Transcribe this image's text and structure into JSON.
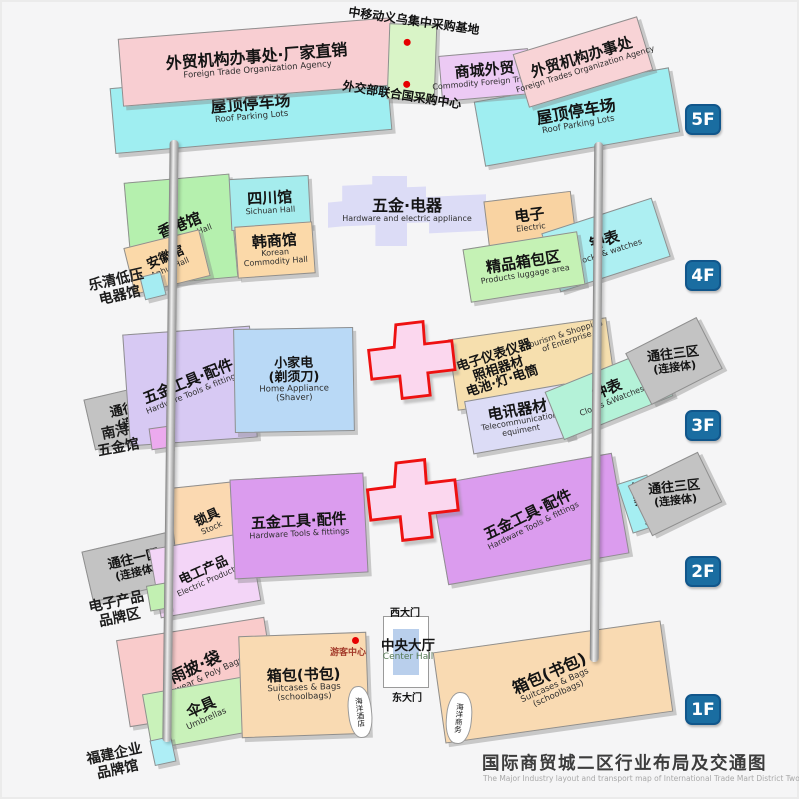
{
  "title": {
    "cn": "国际商贸城二区行业布局及交通图",
    "en": "The Major Industry layout and transport map of International Trade Mart District Two"
  },
  "badges": {
    "f5": "5F",
    "f4": "4F",
    "f3": "3F",
    "f2": "2F",
    "f1": "1F"
  },
  "f5": {
    "agency_left": {
      "cn": "外贸机构办事处·厂家直销",
      "en": "Foreign Trade Organization Agency"
    },
    "roof_left": {
      "cn": "屋顶停车场",
      "en": "Roof Parking Lots"
    },
    "cmcc_label": "中移动义乌集中采购基地",
    "mofa_label": "外交部联合国采购中心",
    "commodity": {
      "cn": "商城外贸",
      "en": "Commodity Foreign Trades"
    },
    "agency_right": {
      "cn": "外贸机构办事处",
      "en": "Foreign Trades Organization Agency"
    },
    "roof_right": {
      "cn": "屋顶停车场",
      "en": "Roof Parking Lots"
    }
  },
  "f4": {
    "hongkong": {
      "cn": "香港馆",
      "en": "HongKong Hall"
    },
    "sichuan": {
      "cn": "四川馆",
      "en": "Sichuan Hall"
    },
    "anhui": {
      "cn": "安徽馆",
      "en": "Anhui Hall"
    },
    "korean": {
      "cn": "韩商馆",
      "en1": "Korean",
      "en2": "Commodity Hall"
    },
    "hardware": {
      "cn": "五金·电器",
      "en": "Hardware and electric appliance"
    },
    "electric": {
      "cn": "电子",
      "en": "Electric"
    },
    "clocks": {
      "cn": "钟表",
      "en": "Clocks & watches"
    },
    "luggage": {
      "cn": "精品箱包区",
      "en": "Products luggage area"
    },
    "side_label": {
      "line1": "乐清低压",
      "line2": "电器馆"
    }
  },
  "f3": {
    "west_connector": {
      "cn": "通往一区",
      "sub": "(连接体)"
    },
    "tools": {
      "cn": "五金工具·配件",
      "en": "Hardware Tools & fittings"
    },
    "appliance": {
      "cn1": "小家电",
      "cn2": "(剃须刀)",
      "en1": "Home Appliance",
      "en2": "(Shaver)"
    },
    "instruments": {
      "cn1": "电子仪表仪器",
      "cn2": "照相器材",
      "cn3": "电池·灯·电筒",
      "en1": "Tourism & Shopping",
      "en2": "of Enterprise"
    },
    "telecom": {
      "cn": "电讯器材",
      "en1": "Telecommunication",
      "en2": "equiment"
    },
    "clocks": {
      "cn": "钟表",
      "en": "Clocks &Watches"
    },
    "east_connector": {
      "cn": "通往三区",
      "sub": "(连接体)"
    },
    "side_label": {
      "line1": "南浔",
      "line2": "五金馆"
    }
  },
  "f2": {
    "west_connector": {
      "cn": "通往一区",
      "sub": "(连接体)"
    },
    "locks": {
      "cn": "锁具",
      "en": "Stock"
    },
    "electric_products": {
      "cn": "电工产品",
      "en": "Electric Products"
    },
    "tools_left": {
      "cn": "五金工具·配件",
      "en": "Hardware Tools & fittings"
    },
    "tools_right": {
      "cn": "五金工具·配件",
      "en": "Hardware Tools & fittings"
    },
    "vehicles": {
      "cn": "车类",
      "en": "Vehicle"
    },
    "east_connector": {
      "cn": "通往三区",
      "sub": "(连接体)"
    },
    "side_label": {
      "line1": "电子产品",
      "line2": "品牌区"
    }
  },
  "f1": {
    "rainwear": {
      "cn": "雨披·袋",
      "en": "Rainwear & Poly Bags"
    },
    "umbrellas": {
      "cn": "伞具",
      "en": "Umbrellas"
    },
    "bags_left": {
      "cn": "箱包(书包)",
      "en1": "Suitcases & Bags",
      "en2": "(schoolbags)"
    },
    "bags_right": {
      "cn": "箱包(书包)",
      "en1": "Suitcases & Bags",
      "en2": "(schoolbags)"
    },
    "visitor_center": "游客中心",
    "west_gate": "西大门",
    "east_gate": "东大门",
    "center_hall": {
      "cn": "中央大厅",
      "en": "Center Hall"
    },
    "ocean_hotel": "海洋酒店",
    "ocean_business": "海洋商务",
    "side_label": {
      "line1": "福建企业",
      "line2": "品牌馆"
    }
  },
  "palette": {
    "background": "#f5f5f6",
    "badge_blue": "#1a6da1",
    "bridge_outline_red": "#ee1111",
    "bridge_fill_pink": "#fbd7ee",
    "marker_red": "#e60000",
    "connector_gray": "#c3c3c3",
    "pink": "#f8ced2",
    "cyan": "#9feef1",
    "green_light": "#d9f4c7",
    "purple_light": "#eccaf4",
    "hall_green": "#b5f0ae",
    "hall_cyan": "#a5eced",
    "hall_orange": "#fbd9a9",
    "lavender": "#dcdcf6",
    "mint": "#b4f2d8",
    "blue_light": "#b9d9f6",
    "violet": "#d7c9f3",
    "purple": "#db9cee",
    "pink_light": "#f3d5f7",
    "peach": "#f9dab2",
    "bag_green": "#c9f2ba",
    "center_hall_blue": "#b9cfec"
  }
}
